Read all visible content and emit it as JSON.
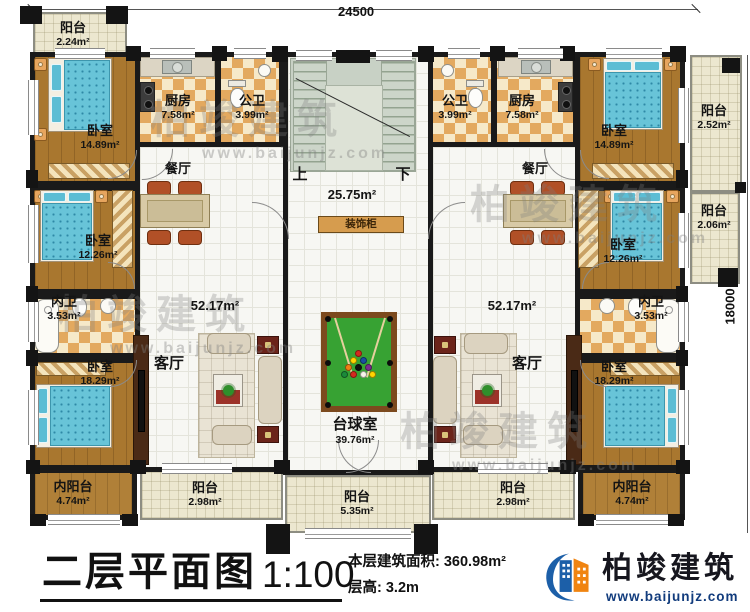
{
  "dimensions": {
    "width": "24500",
    "height": "18000"
  },
  "watermark": {
    "brand": "柏竣建筑",
    "url": "www.baijunjz.com"
  },
  "stairwell": {
    "up": "上",
    "down": "下",
    "area": "25.75m²",
    "cabinet": "装饰柜"
  },
  "legend": {
    "title": "二层平面图",
    "scale": "1:100",
    "floor_area": "本层建筑面积: 360.98m²",
    "floor_height": "层高: 3.2m"
  },
  "logo": {
    "brand": "柏竣建筑",
    "url": "www.baijunjz.com"
  },
  "rooms": [
    {
      "name": "阳台",
      "area": "2.24m²"
    },
    {
      "name": "卧室",
      "area": "14.89m²"
    },
    {
      "name": "厨房",
      "area": "7.58m²"
    },
    {
      "name": "公卫",
      "area": "3.99m²"
    },
    {
      "name": "餐厅",
      "area": ""
    },
    {
      "name": "卧室",
      "area": "12.26m²"
    },
    {
      "name": "内卫",
      "area": "3.53m²"
    },
    {
      "name": "卧室",
      "area": "18.29m²"
    },
    {
      "name": "内阳台",
      "area": "4.74m²"
    },
    {
      "name": "客厅",
      "area": "52.17m²"
    },
    {
      "name": "阳台",
      "area": "2.98m²"
    },
    {
      "name": "台球室",
      "area": "39.76m²"
    },
    {
      "name": "阳台",
      "area": "5.35m²"
    },
    {
      "name": "公卫",
      "area": "3.99m²"
    },
    {
      "name": "厨房",
      "area": "7.58m²"
    },
    {
      "name": "卧室",
      "area": "14.89m²"
    },
    {
      "name": "阳台",
      "area": "2.52m²"
    },
    {
      "name": "餐厅",
      "area": ""
    },
    {
      "name": "卧室",
      "area": "12.26m²"
    },
    {
      "name": "阳台",
      "area": "2.06m²"
    },
    {
      "name": "内卫",
      "area": "3.53m²"
    },
    {
      "name": "卧室",
      "area": "18.29m²"
    },
    {
      "name": "内阳台",
      "area": "4.74m²"
    },
    {
      "name": "客厅",
      "area": "52.17m²"
    },
    {
      "name": "阳台",
      "area": "2.98m²"
    }
  ]
}
